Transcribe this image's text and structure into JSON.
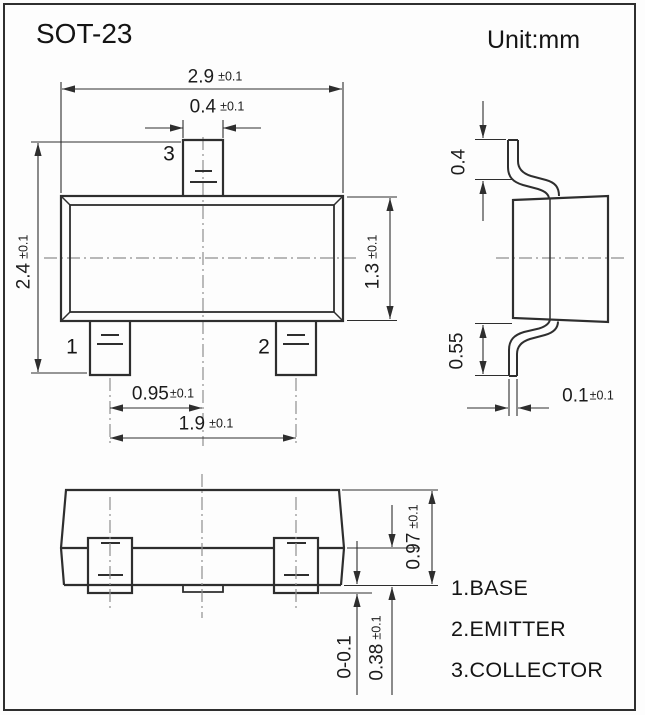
{
  "title": "SOT-23",
  "unit_label": "Unit:mm",
  "views": {
    "front": {
      "pin_labels": {
        "pin1": "1",
        "pin2": "2",
        "pin3": "3"
      },
      "dims": {
        "body_width": {
          "value": "2.9",
          "tol": "±0.1"
        },
        "lead_width": {
          "value": "0.4",
          "tol": "±0.1"
        },
        "overall_height": {
          "value": "2.4",
          "tol": "±0.1"
        },
        "body_height": {
          "value": "1.3",
          "tol": "±0.1"
        },
        "lead_pitch": {
          "value": "0.95",
          "tol": "±0.1"
        },
        "lead_span": {
          "value": "1.9",
          "tol": "±0.1"
        }
      }
    },
    "side": {
      "dims": {
        "top_lead_length": {
          "value": "0.4",
          "tol": ""
        },
        "bottom_lead_length": {
          "value": "0.55",
          "tol": ""
        },
        "lead_thickness": {
          "value": "0.1",
          "tol": "±0.1"
        }
      }
    },
    "bottom": {
      "dims": {
        "body_thickness": {
          "value": "0.97",
          "tol": "±0.1"
        },
        "standoff": {
          "value": "0-0.1",
          "tol": ""
        },
        "lead_foot": {
          "value": "0.38",
          "tol": "±0.1"
        }
      }
    }
  },
  "legend": {
    "items": [
      {
        "label": "1.BASE"
      },
      {
        "label": "2.EMITTER"
      },
      {
        "label": "3.COLLECTOR"
      }
    ]
  },
  "colors": {
    "line": "#2e2e2e",
    "centerline": "#8f8f8f",
    "text": "#1c1c1c",
    "background": "#fdfdfd"
  }
}
